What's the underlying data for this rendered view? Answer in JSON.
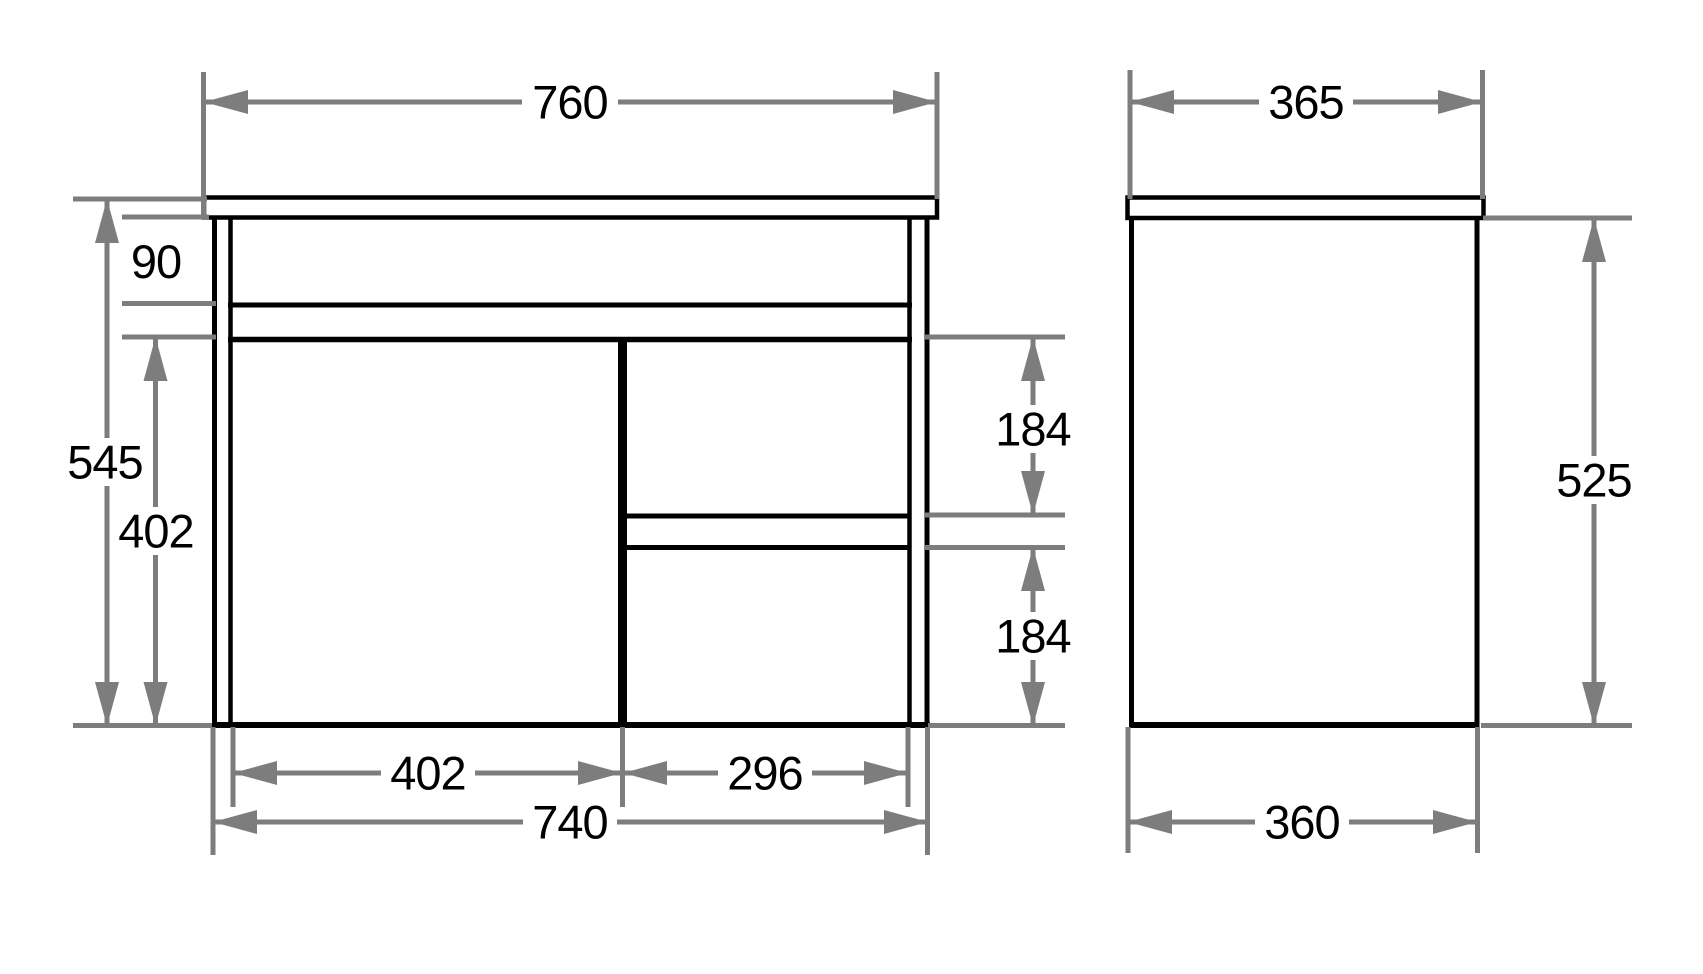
{
  "drawing": {
    "colors": {
      "structure_line": "#000000",
      "dimension_line": "#7d7d7d",
      "background": "#ffffff"
    },
    "dims": {
      "countertop_width": "760",
      "top_rail_height": "90",
      "overall_height": "545",
      "door_height": "402",
      "drawer_top_height": "184",
      "drawer_bottom_height": "184",
      "door_width": "402",
      "drawer_width": "296",
      "cabinet_width": "740",
      "countertop_depth": "365",
      "body_height": "525",
      "body_depth": "360"
    }
  }
}
